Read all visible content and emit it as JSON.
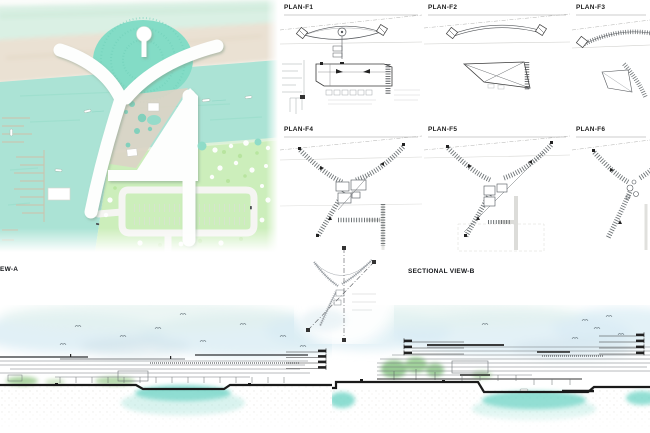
{
  "plans": {
    "items": [
      {
        "id": "plan-f1",
        "label": "PLAN-F1"
      },
      {
        "id": "plan-f2",
        "label": "PLAN-F2"
      },
      {
        "id": "plan-f3",
        "label": "PLAN-F3"
      },
      {
        "id": "plan-f4",
        "label": "PLAN-F4"
      },
      {
        "id": "plan-f5",
        "label": "PLAN-F5"
      },
      {
        "id": "plan-f6",
        "label": "PLAN-F6"
      }
    ]
  },
  "sections": {
    "a": {
      "label": "EW-A"
    },
    "b": {
      "label": "SECTIONAL VIEW-B"
    }
  },
  "palette": {
    "mint_band": "#d8efe3",
    "sand_band": "#eae1d3",
    "water": "#abe3d5",
    "mound_green": "#83dcc6",
    "lawn": "#cceebb",
    "building_white": "#fdfefd",
    "plaza": "#dbd4c6",
    "plan_linework": "#55585c",
    "section_sky": "#d9ecf4",
    "section_water": "#6fd4c6",
    "section_tree": "#8cc487",
    "ink": "#1c1c1c"
  }
}
